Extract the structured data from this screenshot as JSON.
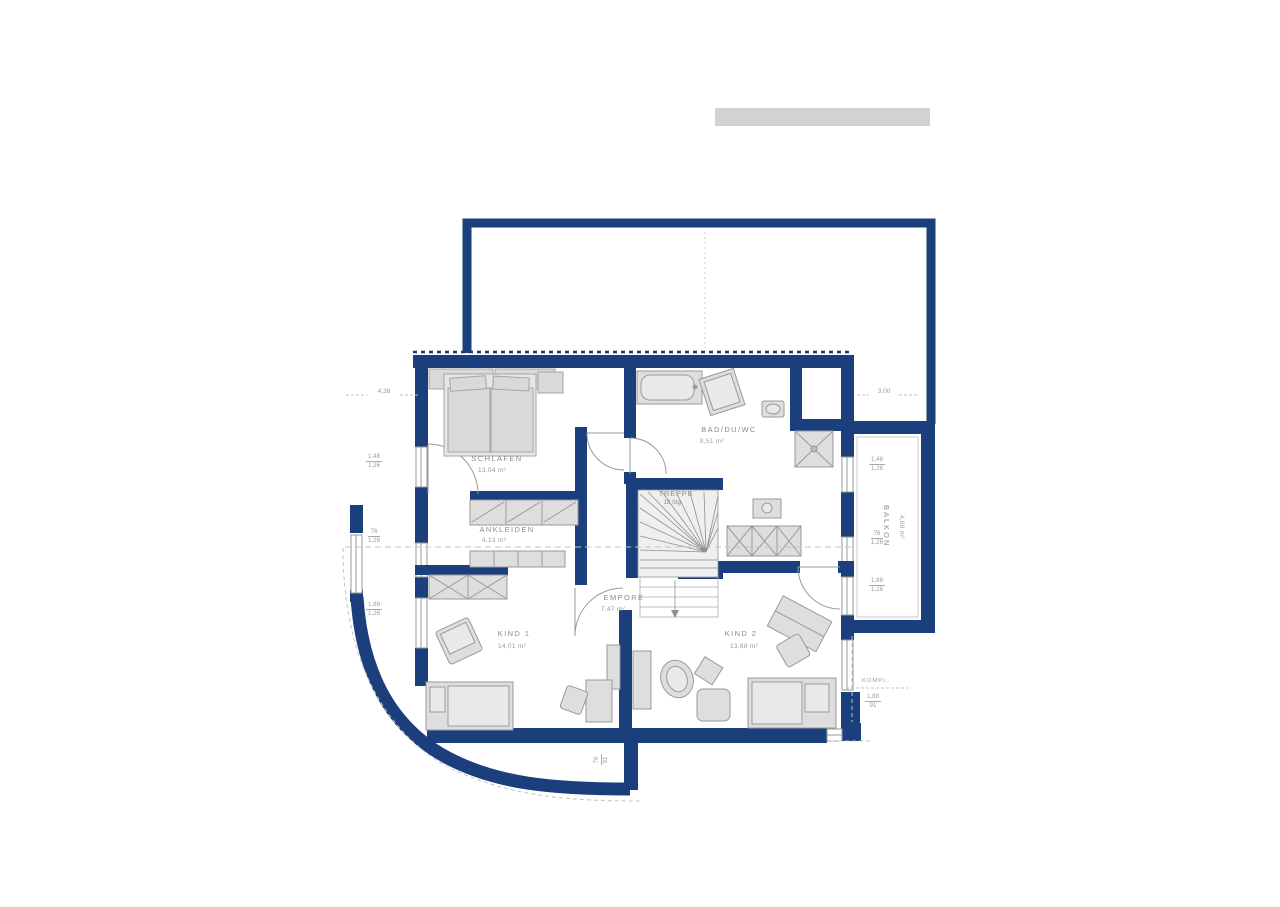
{
  "rooms": {
    "schlafen": {
      "label": "SCHLAFEN",
      "area": "13,04 m²"
    },
    "ankleiden": {
      "label": "ANKLEIDEN",
      "area": "4,13 m²"
    },
    "bad": {
      "label": "BAD/DU/WC",
      "area": "8,51 m²"
    },
    "treppe": {
      "label": "TREPPE",
      "steps": "18 Stg."
    },
    "empore": {
      "label": "EMPORE",
      "area": "7,47 m²"
    },
    "kind1": {
      "label": "KIND 1",
      "area": "14,01 m²"
    },
    "kind2": {
      "label": "KIND 2",
      "area": "13,88 m²"
    },
    "balkon": {
      "label": "BALKON",
      "area": "4,68 m²"
    }
  },
  "dimensions": {
    "top_left": "4,38",
    "top_right": "3,00",
    "left_1": {
      "top": "1,48",
      "bottom": "1,26"
    },
    "left_2": {
      "top": "76",
      "bottom": "1,26"
    },
    "left_3": {
      "top": "1,88",
      "bottom": "1,26"
    },
    "right_1": {
      "top": "1,48",
      "bottom": "1,26"
    },
    "right_2": {
      "top": "76",
      "bottom": "1,26"
    },
    "right_3": {
      "top": "1,88",
      "bottom": "1,26"
    },
    "bottom_right_note": "KOMPL.",
    "bottom_right": {
      "top": "1,88",
      "bottom": "91"
    },
    "bottom": {
      "top": "76",
      "bottom": "91"
    }
  },
  "colors": {
    "wall": "#1b3e7c",
    "furniture_fill": "#dedede",
    "furniture_stroke": "#9a9a9a",
    "label_text": "#8b8b8b",
    "dash_line": "#c3c3c3",
    "logo_bar": "#d2d2d2"
  }
}
